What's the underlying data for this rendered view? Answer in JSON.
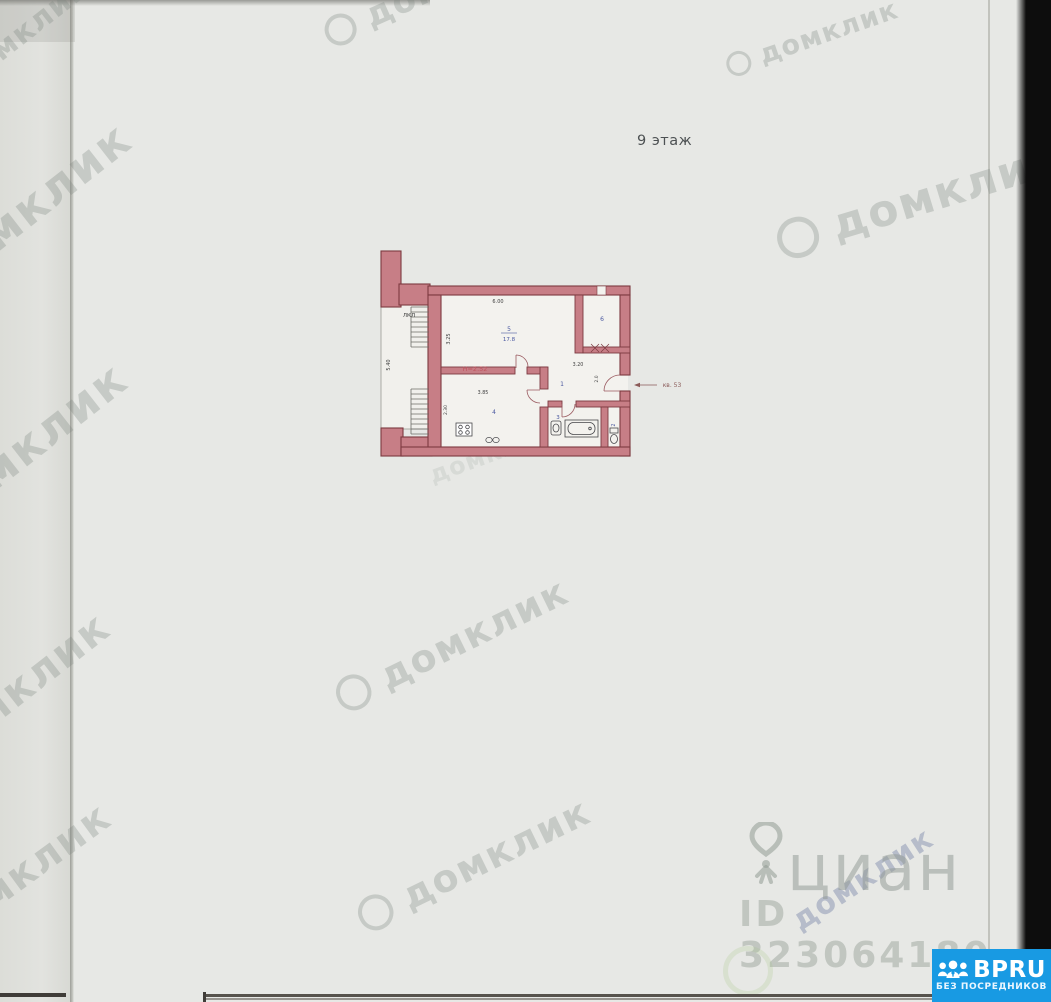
{
  "photo": {
    "floor_label": "9 этаж"
  },
  "plan": {
    "stairwell_label": "ЛКЛ",
    "height_label": "H=2.52",
    "apartment_label": "кв. 53",
    "rooms": [
      {
        "number": "5",
        "area": "17.8"
      },
      {
        "number": "6"
      },
      {
        "number": "1"
      },
      {
        "number": "2"
      },
      {
        "number": "3"
      },
      {
        "number": "4"
      }
    ],
    "dimensions": {
      "top_width": "6.00",
      "living_depth": "3.25",
      "stair_depth": "5.40",
      "kitchen_width": "3.85",
      "kitchen_depth": "2.30",
      "hall_width": "3.20",
      "hall_depth": "2.0"
    },
    "colors": {
      "wall_fill": "#c77e86",
      "wall_stroke": "#7c3a40",
      "room_label_blue": "#4a58a0",
      "height_label_red": "#c05560"
    }
  },
  "watermarks": {
    "domclick": "домклик",
    "cian": "циан",
    "cian_id": "ID 323064180"
  },
  "logo": {
    "brand": "BPRU",
    "tagline": "БЕЗ ПОСРЕДНИКОВ",
    "background": "#189ae3"
  }
}
